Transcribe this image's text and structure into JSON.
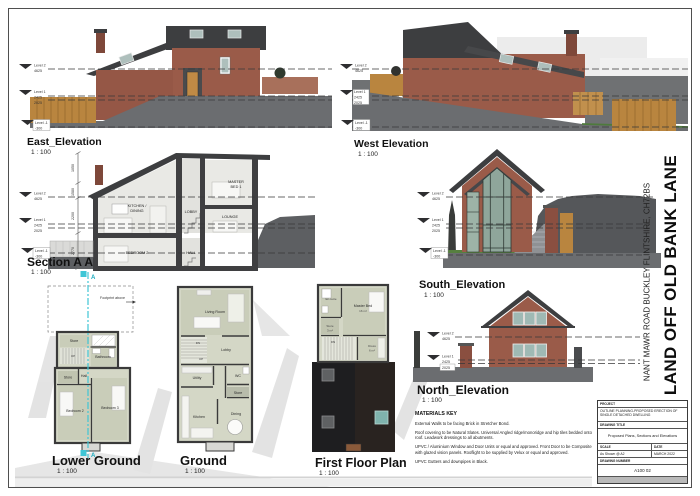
{
  "sheet": {
    "project_title": "LAND OFF OLD BANK LANE",
    "project_address": "NANT MAWR ROAD BUCKLEY FLINTSHIRE, CH72BS"
  },
  "views": {
    "east": {
      "title": "East_Elevation",
      "scale": "1 : 100"
    },
    "west": {
      "title": "West Elevation",
      "scale": "1 : 100"
    },
    "section": {
      "title": "Section A A",
      "scale": "1 : 100"
    },
    "south": {
      "title": "South_Elevation",
      "scale": "1 : 100"
    },
    "north": {
      "title": "North_Elevation",
      "scale": "1 : 100"
    },
    "lower_ground": {
      "title": "Lower Ground",
      "scale": "1 : 100"
    },
    "ground": {
      "title": "Ground",
      "scale": "1 : 100"
    },
    "first_floor": {
      "title": "First Floor Plan",
      "scale": "1 : 100"
    }
  },
  "levels": {
    "level2_name": "Level 2",
    "level2_value": "4625",
    "level1_name": "Level 1",
    "level1_value": "2425",
    "level1_alt": "2025",
    "levelm1_name": "Level -1",
    "levelm1_value": "-300"
  },
  "section_view": {
    "rooms": {
      "kitchen_line1": "KITCHEN /",
      "kitchen_line2": "DINING",
      "master_line1": "MASTER",
      "master_line2": "BED 1",
      "lobby": "LOBBY",
      "lounge": "LOUNGE",
      "bedroom2": "BEDROOM 2",
      "hall": "HALL"
    },
    "dims": {
      "d1": "1050",
      "d2": "1580",
      "d3": "2200",
      "d4": "2770"
    },
    "marker": "A"
  },
  "plans": {
    "lower_ground": {
      "note": "Footprint above",
      "stair_up": "UP",
      "rooms": {
        "store_top": "Store",
        "bathroom": "Bathroom",
        "store": "Store",
        "hall": "Hall",
        "bedroom2": "Bedroom 2",
        "bedroom3": "Bedroom 3"
      }
    },
    "ground": {
      "stair_dn": "DN",
      "stair_up": "UP",
      "rooms": {
        "living": "Living Room",
        "lobby": "Lobby",
        "utility": "Utility",
        "wc": "WC",
        "store": "Store",
        "kitchen": "Kitchen",
        "dining": "Dining"
      }
    },
    "first_floor": {
      "stair_dn": "DN",
      "rooms": {
        "ensuite": "En-suite",
        "master": "Master Bed",
        "master_area": "16 m²",
        "store": "Store",
        "store_area": "3 m²",
        "dress": "Dress",
        "dress_area": "6 m²"
      }
    }
  },
  "materials_key": {
    "heading": "MATERIALS KEY",
    "line1": "External Walls to be facing Brick in Stretcher Bond.",
    "line2": "Roof covering to be Natural Slates. Universal Angled ridge/monoridge and hip tiles bedded onto roof. Leadwork dressings to all abutments.",
    "line3": "UPVC / Aluminium Window and Door Units or equal and approved. Front Door to be Composite with glazed vision panels. Rooflight to be supplied by Velux or equal and approved.",
    "line4": "UPVC Gutters and downpipes in Black."
  },
  "titleblock": {
    "project_label": "PROJECT",
    "project_value": "OUTLINE PLANNING-PROPOSED ERECTION OF SINGLE DETACHED DWELLING",
    "drawing_title_label": "DRAWING TITLE",
    "drawing_title_value": "Proposed Plans, Sections and Elevations",
    "scale_label": "SCALE",
    "scale_value": "As Shown @ A2",
    "date_label": "DATE",
    "date_value": "MARCH 2022",
    "number_label": "DRAWING NUMBER",
    "number_value": "A100 02"
  },
  "colors": {
    "brick": "#9a5b49",
    "roof": "#3d3e40",
    "ground": "#6b6d70",
    "glass": "#a9bdb4",
    "wood": "#b9853f",
    "section_cyan": "#3fc6d6"
  }
}
